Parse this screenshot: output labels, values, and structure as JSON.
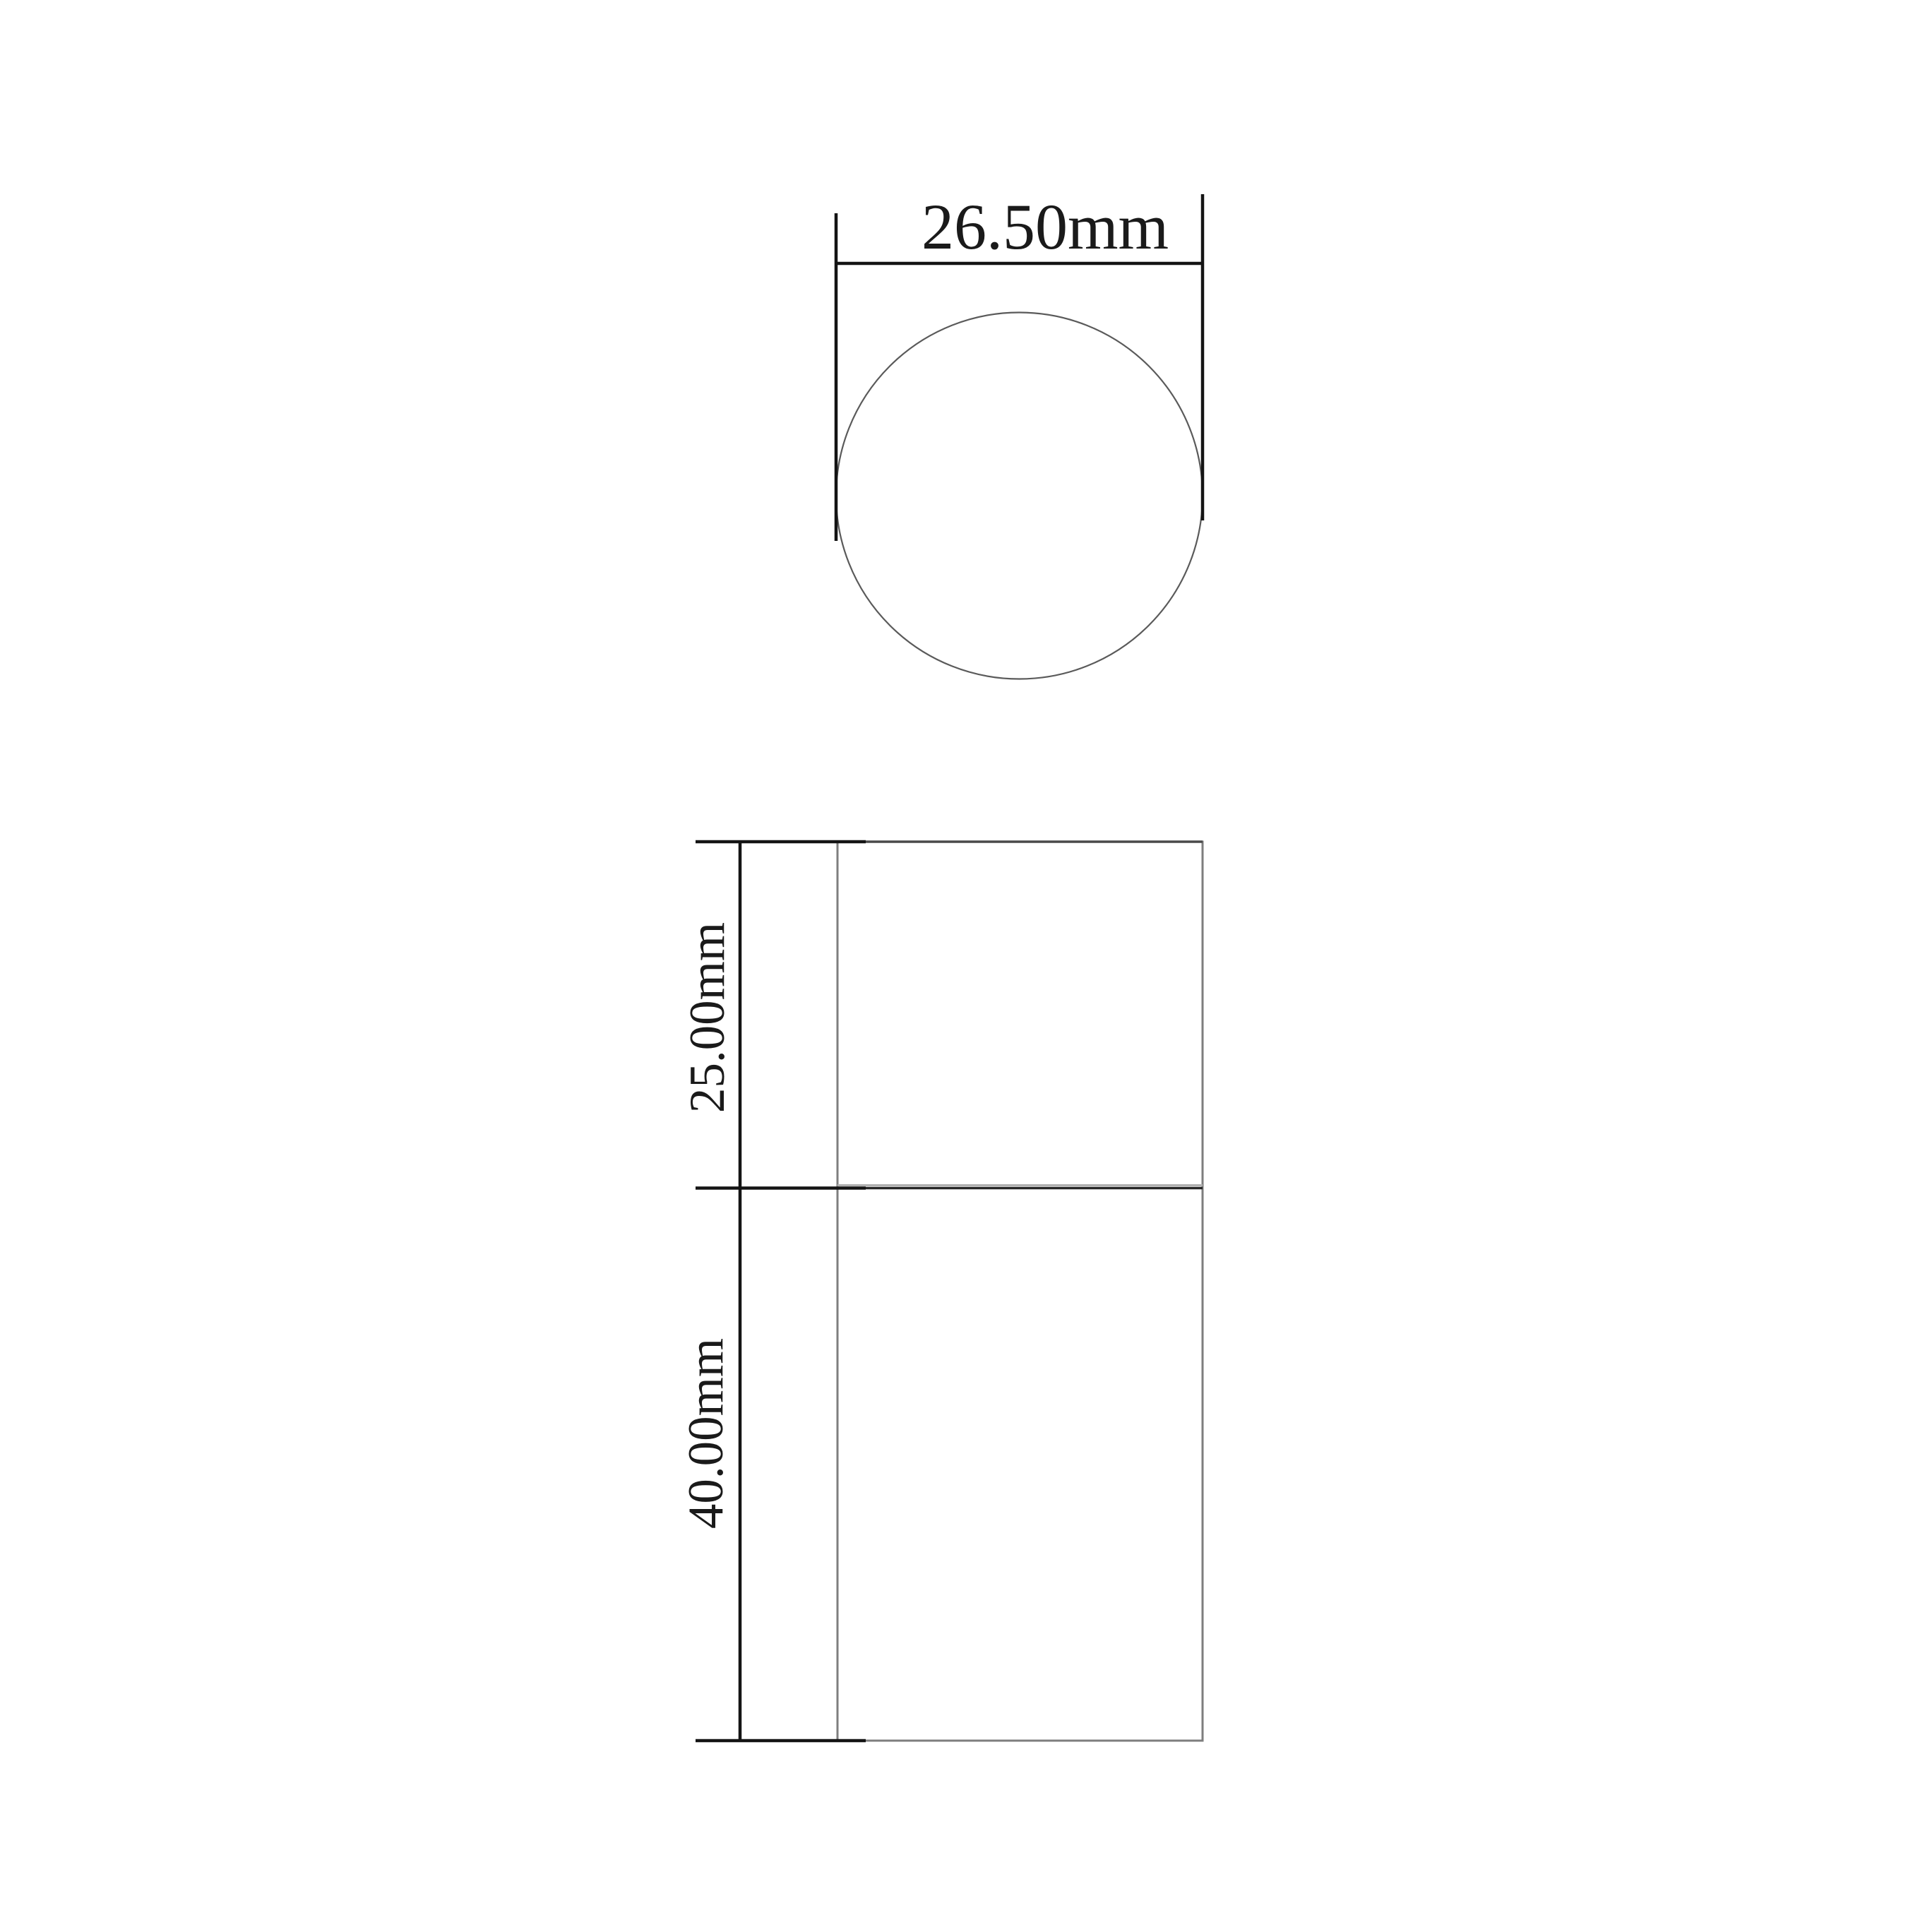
{
  "drawing_type": "technical-dimension-drawing-cylinder",
  "views": {
    "top_view_name": "circular top view",
    "side_view_name": "side elevation view"
  },
  "dimensions": {
    "diameter": {
      "label": "26.50mm",
      "value_mm": 26.5
    },
    "upper_height": {
      "label": "25.00mm",
      "value_mm": 25.0
    },
    "lower_height": {
      "label": "40.00mm",
      "value_mm": 40.0
    }
  },
  "colors": {
    "background": "#ffffff",
    "dimension_line": "#141414",
    "outline": "#7e7e7e",
    "top_edge": "#4a4a4a",
    "divider_dark": "#262626",
    "divider_light": "#b0b0b0",
    "circle_outline": "#5a5a5a",
    "text": "#1a1a1a"
  }
}
